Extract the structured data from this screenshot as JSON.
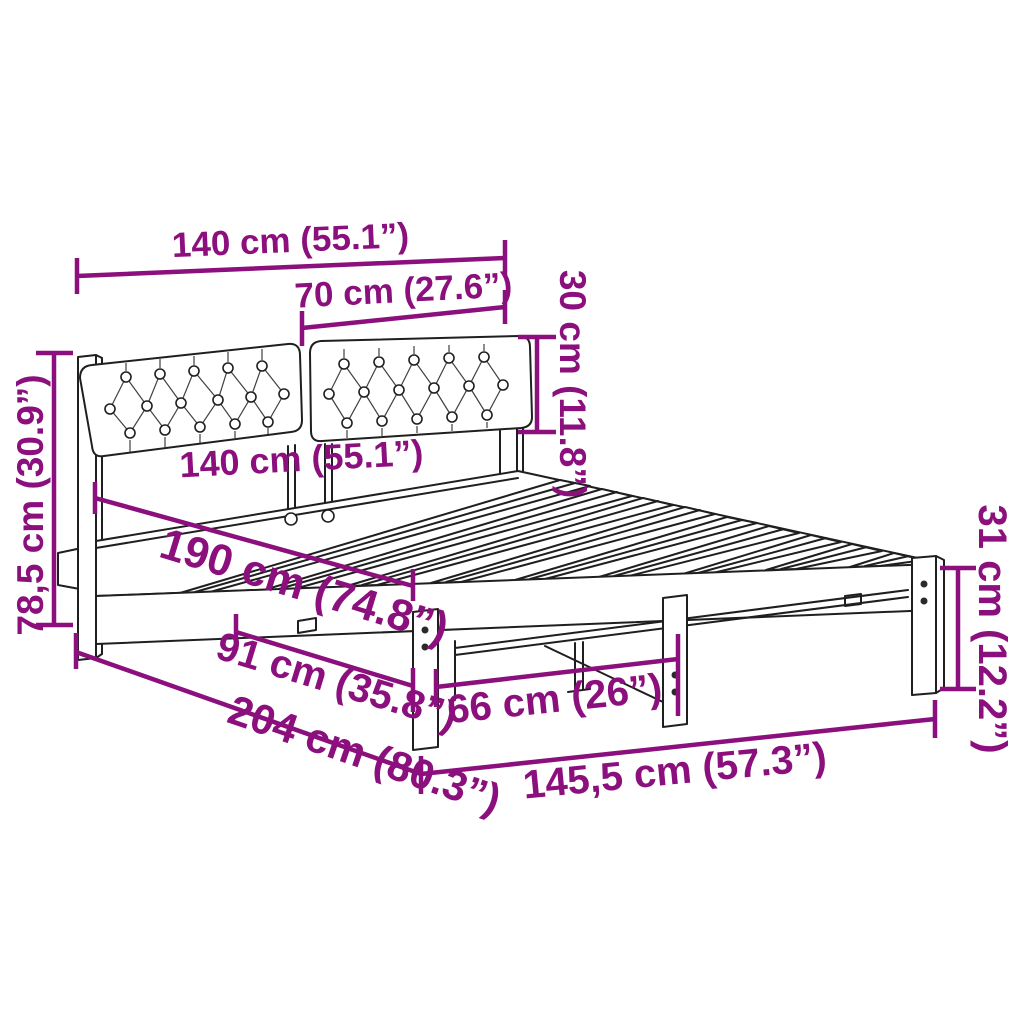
{
  "dimensions": {
    "top_width": "140 cm (55.1”)",
    "cushion_width": "70 cm (27.6”)",
    "cushion_height": "30 cm (11.8”)",
    "headboard_height": "78,5 cm (30.9”)",
    "inner_width": "140 cm (55.1”)",
    "inner_length": "190 cm (74.8”)",
    "clearance_length": "91 cm (35.8”)",
    "total_length": "204 cm (80.3”)",
    "leg_spacing": "66 cm (26”)",
    "frame_length": "145,5 cm (57.3”)",
    "frame_height": "31 cm (12.2”)"
  },
  "colors": {
    "dimension_accent": "#8B0F7C",
    "line_art": "#1F1F1F",
    "background": "#FFFFFF"
  }
}
